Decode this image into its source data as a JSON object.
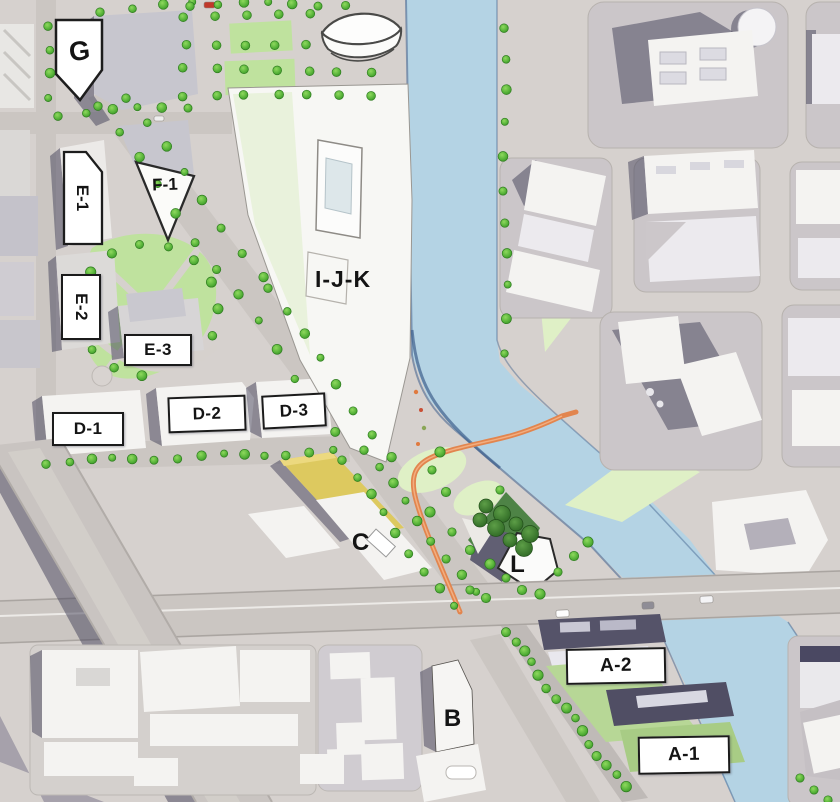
{
  "map": {
    "parcels": [
      {
        "id": "G",
        "label": "G"
      },
      {
        "id": "E-1",
        "label": "E-1"
      },
      {
        "id": "F-1",
        "label": "F-1"
      },
      {
        "id": "E-2",
        "label": "E-2"
      },
      {
        "id": "E-3",
        "label": "E-3"
      },
      {
        "id": "D-1",
        "label": "D-1"
      },
      {
        "id": "D-2",
        "label": "D-2"
      },
      {
        "id": "D-3",
        "label": "D-3"
      },
      {
        "id": "I-J-K",
        "label": "I-J-K"
      },
      {
        "id": "C",
        "label": "C"
      },
      {
        "id": "L",
        "label": "L"
      },
      {
        "id": "B",
        "label": "B"
      },
      {
        "id": "A-2",
        "label": "A-2"
      },
      {
        "id": "A-1",
        "label": "A-1"
      }
    ],
    "colors": {
      "base_gray": "#d6d1ce",
      "road_gray": "#cbc6c2",
      "block_gray": "#cbc6c9",
      "building_white": "#f4f3f1",
      "building_yellow": "#ddc95f",
      "river": "#b4d3e4",
      "river_edge": "#3e5f8c",
      "tree_green": "#4aa832",
      "park_green": "#bfe29e",
      "lawn_light": "#dff0c6",
      "grove_dark": "#3f7a37",
      "bridge_orange": "#e2854e",
      "shadow_navy": "#413f58",
      "label_bg": "#ffffff",
      "label_border": "#1b1b1b",
      "label_text": "#141414"
    }
  }
}
